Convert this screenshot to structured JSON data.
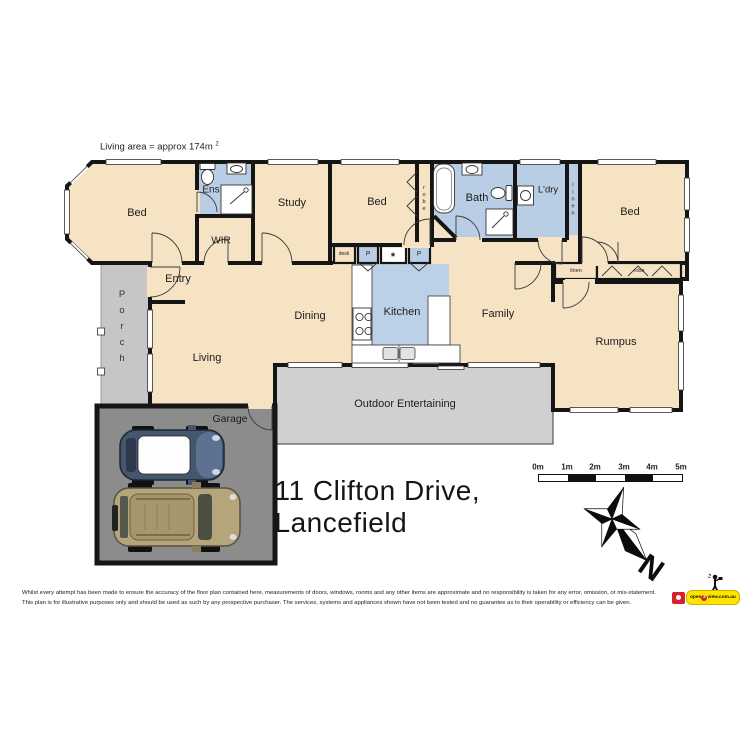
{
  "header": {
    "living_area_text": "Living area = approx 174m",
    "superscript": "2"
  },
  "rooms": {
    "bed1": "Bed",
    "ens": "Ens",
    "wir": "WIR",
    "study": "Study",
    "bed2": "Bed",
    "bath": "Bath",
    "laundry": "L'dry",
    "bed3": "Bed",
    "entry": "Entry",
    "porch": "Porch",
    "living": "Living",
    "dining": "Dining",
    "kitchen": "Kitchen",
    "family": "Family",
    "rumpus": "Rumpus",
    "garage": "Garage",
    "outdoor": "Outdoor Entertaining"
  },
  "closets": {
    "robe_vertical": "robe",
    "linen_vertical": "linen",
    "linen_small": "linen",
    "robe_small": "robe",
    "desk": "desk",
    "pantry_left": "P",
    "appliance": "*",
    "pantry_right": "P"
  },
  "address": "11 Clifton Drive,  Lancefield",
  "scale_bar": {
    "labels": [
      "0m",
      "1m",
      "2m",
      "3m",
      "4m",
      "5m"
    ]
  },
  "compass": {
    "north": "N"
  },
  "disclaimer": {
    "line1": "Whilst every attempt has been made to ensure the accuracy of the floor plan contained here, measurements of doors, windows, rooms and any other items are approximate and no responsibility is taken for any error, omission, or mis-statement.",
    "line2": "This plan is for illustrative purposes only and should be used as such by any prospective purchaser. The services, systems and appliances shown have not been tested and no guarantee as to their operability or efficiency can be given."
  },
  "logo": {
    "prefix": "open",
    "two": "2",
    "suffix": "view.com.au"
  },
  "colors": {
    "room_cream": "#f5e3c4",
    "wet_area_blue": "#b9cee5",
    "porch_gray": "#c6c6c6",
    "outdoor_gray": "#d0d0d0",
    "garage_gray": "#8c8c8c",
    "wall_black": "#151515",
    "car1_blue": "#46566e",
    "car2_tan": "#b4a67a",
    "logo_yellow": "#ffe400",
    "logo_red": "#d3222a"
  }
}
